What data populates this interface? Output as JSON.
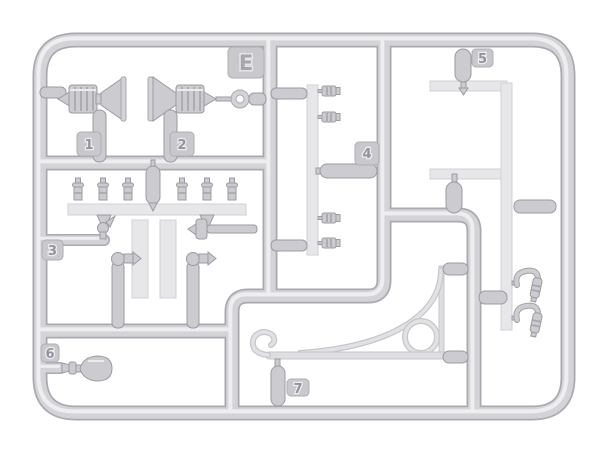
{
  "sprue": {
    "letter_tag": {
      "label": "E"
    },
    "part_tags": [
      {
        "label": "1"
      },
      {
        "label": "2"
      },
      {
        "label": "3"
      },
      {
        "label": "4"
      },
      {
        "label": "5"
      },
      {
        "label": "6"
      },
      {
        "label": "7"
      }
    ],
    "colors": {
      "background": "#ffffff",
      "runner_base": "#d4d4d8",
      "runner_shadow": "#a9a9af",
      "runner_highlight": "#eeeef0",
      "plank": "#e7e7ea",
      "part": "#cbcbd0",
      "tag_face": "#c9c9cd"
    }
  }
}
